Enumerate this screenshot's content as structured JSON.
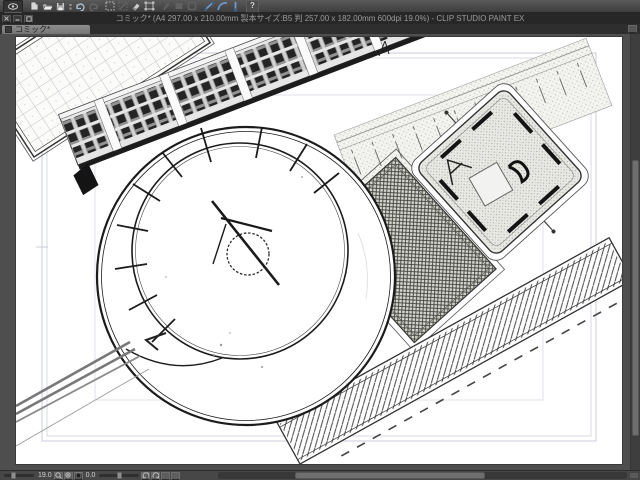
{
  "window": {
    "title": "コミック* (A4 297.00 x 210.00mm 製本サイズ:B5 判 257.00 x 182.00mm 600dpi 19.0%) - CLIP STUDIO PAINT EX",
    "app_name": "CLIP STUDIO PAINT EX",
    "controls": [
      "close",
      "minimize",
      "restore"
    ]
  },
  "toolbar": {
    "help_label": "?",
    "icons": [
      "eye",
      "new-file",
      "open-folder",
      "save",
      "overflow-dots",
      "undo",
      "redo",
      "select-area",
      "deselect",
      "erase",
      "transform",
      "disabled-a",
      "disabled-b",
      "disabled-c",
      "snap-ruler",
      "snap-curve",
      "snap-special",
      "help"
    ]
  },
  "tabbar": {
    "tabs": [
      {
        "label": "コミック*",
        "active": true
      }
    ]
  },
  "canvas": {
    "document_name": "コミック*",
    "zoom_percent": "19.0",
    "content": "architectural aerial line drawing: circular plaza with clock-hand mark, gridded terrace, apartment slab with windows, hatched garden square, playground pavilion, striped walkway, access road"
  },
  "statusbar": {
    "zoom_value": "19.0",
    "rotation_value": "0.0"
  },
  "colors": {
    "accent_blue": "#6f9bd1",
    "chrome_dark": "#272727",
    "chrome_mid": "#4a4a4a",
    "tab_active": "#858585",
    "page": "#ffffff",
    "guide": "#c9cdd8",
    "ink": "#1b1b1b"
  }
}
